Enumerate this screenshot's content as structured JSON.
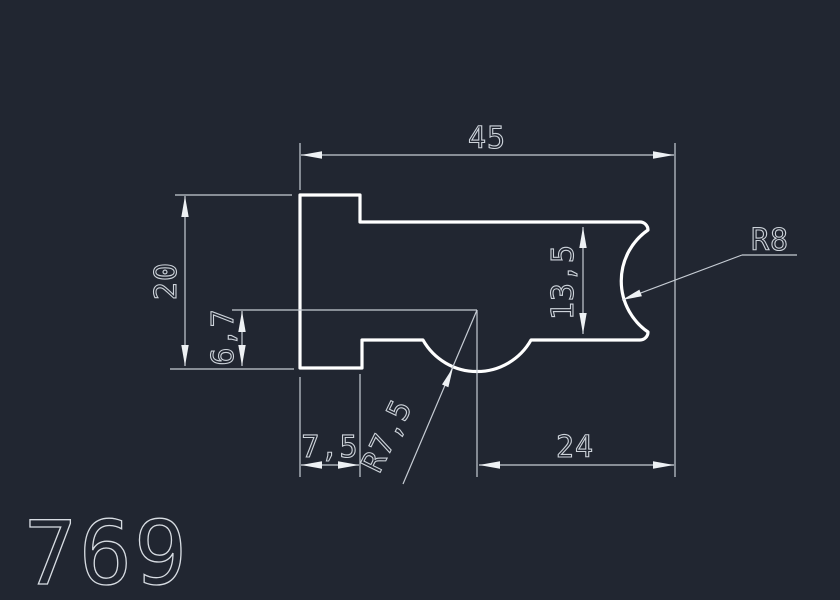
{
  "canvas": {
    "background_color": "#212631",
    "profile_line_color": "#ffffff",
    "dimension_line_color": "#c6ccd4",
    "text_color": "#cdd3da"
  },
  "drawing": {
    "part_number": "769",
    "dim_total_width": "45",
    "dim_left_height": "20",
    "dim_step_height": "6,7",
    "dim_tab_width": "7,5",
    "dim_right_width": "24",
    "dim_right_height": "13,5",
    "radius_right": "R8",
    "radius_bottom": "R7,5"
  }
}
